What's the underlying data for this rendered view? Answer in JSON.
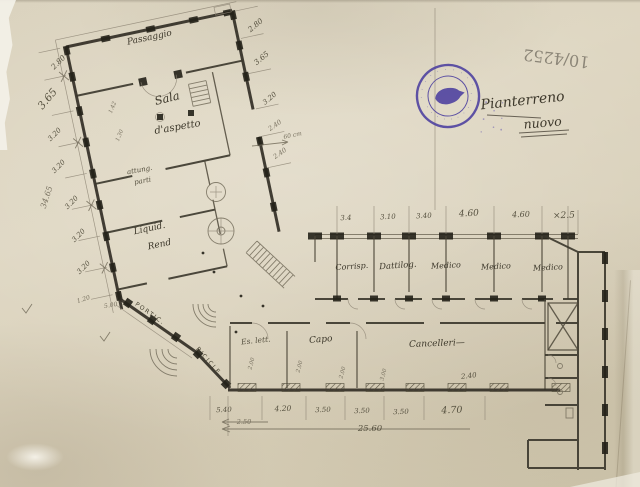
{
  "document": {
    "inventory_number": "10/4252",
    "title_line1": "Pianterreno",
    "title_line2": "nuovo"
  },
  "stamp": {
    "rim_text_top": "· · · · · · · · · · · · · ·",
    "rim_text_bottom": "· · · · · · · · · ·",
    "color": "#473a9e"
  },
  "rooms": {
    "passaggio": "Passaggio",
    "sala_line1": "Sala",
    "sala_line2": "d'aspetto",
    "attung_line1": "attung.",
    "attung_line2": "parti",
    "liquid_line1": "Liquid.",
    "liquid_line2": "Rend",
    "portico": "PORTIC.",
    "bicicle": "BICICLE",
    "corrisp": "Corrisp.",
    "dattilog": "Dattilog.",
    "medico_1": "Medico",
    "medico_2": "Medico",
    "medico_3": "Medico",
    "es_lett": "Es. lett.",
    "capo": "Capo",
    "cancelleria": "Cancelleri—"
  },
  "dimensions": {
    "left_column": [
      "2.80",
      "3.65",
      "3.20",
      "3.20",
      "3.20",
      "3.20",
      "3.20"
    ],
    "left_small_1": "1.20",
    "left_small_2": "5.00",
    "left_total": "34.65",
    "inner_column": [
      "2.80",
      "3.65",
      "3.20",
      "2.40",
      "60 cm",
      "2.40"
    ],
    "wing_top": [
      "3.4",
      "3.10",
      "3.40",
      "4.60",
      "4.60",
      "×2.5"
    ],
    "bottom_row": [
      "5.40",
      "4.20",
      "3.50",
      "3.50",
      "3.50",
      "4.70"
    ],
    "bottom_offset": "2.50",
    "bottom_total": "25.60",
    "cancelleria_width": "2.40",
    "room_marks": [
      "2.00",
      "2.00",
      "2.00",
      "3.00"
    ],
    "sala_marks": [
      "1.42",
      "1.30"
    ]
  }
}
